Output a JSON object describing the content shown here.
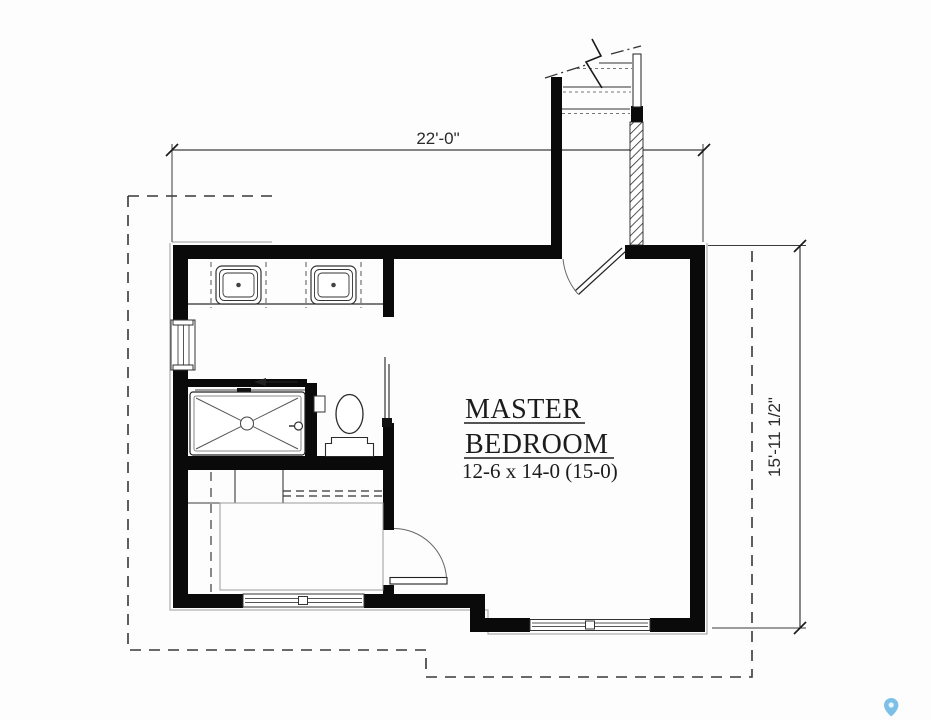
{
  "room": {
    "name_line1": "MASTER",
    "name_line2": "BEDROOM",
    "size": "12-6 x 14-0 (15-0)"
  },
  "dimensions": {
    "width": "22'-0\"",
    "height": "15'-11 1/2\""
  },
  "colors": {
    "wall": "#0a0a0a",
    "dim_line": "#3c3c3c",
    "accent_pin": "#7cc0e8"
  },
  "icons": {
    "map_pin": "map-pin-icon"
  }
}
